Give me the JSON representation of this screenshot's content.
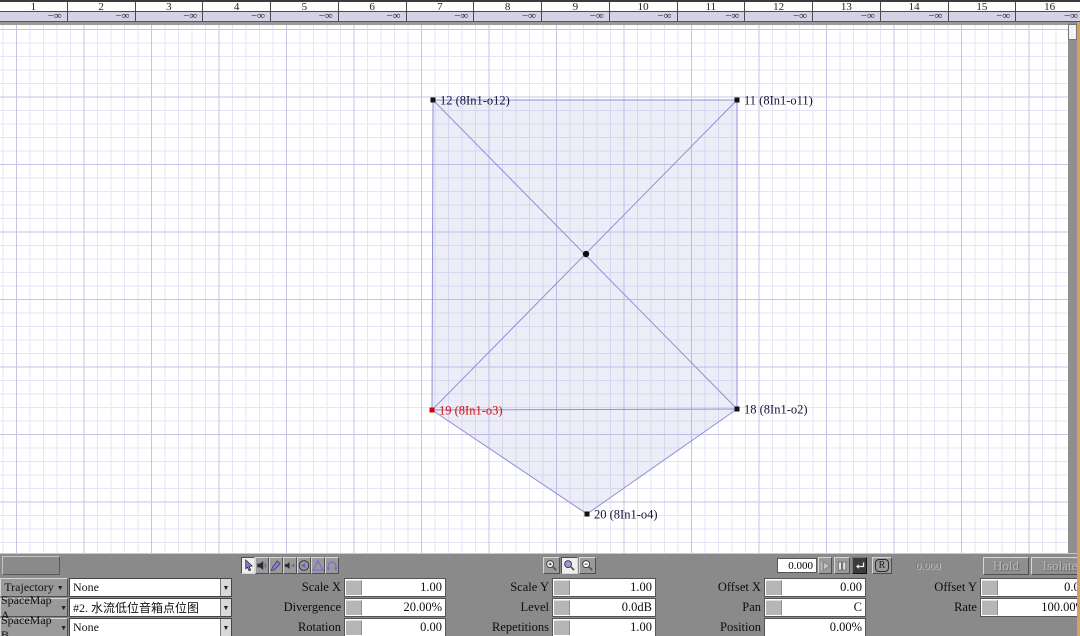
{
  "accent": {
    "grid_major": "#c7c4e7",
    "grid_minor": "#e6e4f5",
    "map_stroke": "#9090d6",
    "map_fill": "rgba(146,146,214,0.16)",
    "selected_red": "#cc1111",
    "panel_gray": "#8a8a8a",
    "meter_lavender": "#d7d1e5",
    "edge_tan": "#cfa55c"
  },
  "channel_meter": {
    "channels": [
      {
        "num": "1",
        "level": "−∞"
      },
      {
        "num": "2",
        "level": "−∞"
      },
      {
        "num": "3",
        "level": "−∞"
      },
      {
        "num": "4",
        "level": "−∞"
      },
      {
        "num": "5",
        "level": "−∞"
      },
      {
        "num": "6",
        "level": "−∞"
      },
      {
        "num": "7",
        "level": "−∞"
      },
      {
        "num": "8",
        "level": "−∞"
      },
      {
        "num": "9",
        "level": "−∞"
      },
      {
        "num": "10",
        "level": "−∞"
      },
      {
        "num": "11",
        "level": "−∞"
      },
      {
        "num": "12",
        "level": "−∞"
      },
      {
        "num": "13",
        "level": "−∞"
      },
      {
        "num": "14",
        "level": "−∞"
      },
      {
        "num": "15",
        "level": "−∞"
      },
      {
        "num": "16",
        "level": "−∞"
      }
    ]
  },
  "canvas": {
    "nodes": [
      {
        "id": "12",
        "label": "12 (8In1-o12)",
        "x": 433,
        "y": 100,
        "color": "#111111",
        "text": "#15153a"
      },
      {
        "id": "11",
        "label": "11 (8In1-o11)",
        "x": 737,
        "y": 100,
        "color": "#111111",
        "text": "#15153a"
      },
      {
        "id": "18",
        "label": "18 (8In1-o2)",
        "x": 737,
        "y": 409,
        "color": "#111111",
        "text": "#15153a"
      },
      {
        "id": "19",
        "label": "19 (8In1-o3)",
        "x": 432,
        "y": 410,
        "color": "#dd0000",
        "text": "#cc1111"
      },
      {
        "id": "20",
        "label": "20 (8In1-o4)",
        "x": 587,
        "y": 514,
        "color": "#111111",
        "text": "#15153a"
      }
    ],
    "center": {
      "x": 586,
      "y": 254
    },
    "fills": [
      [
        "12",
        "11",
        "18",
        "20",
        "19"
      ]
    ],
    "edges": [
      [
        "12",
        "11"
      ],
      [
        "11",
        "18"
      ],
      [
        "18",
        "19"
      ],
      [
        "19",
        "12"
      ],
      [
        "19",
        "20"
      ],
      [
        "20",
        "18"
      ],
      [
        "12",
        "18"
      ],
      [
        "11",
        "19"
      ]
    ]
  },
  "transport": {
    "tools": [
      {
        "name": "cursor-tool",
        "active": true
      },
      {
        "name": "speaker-tool",
        "active": false
      },
      {
        "name": "draw-trajectory-tool",
        "active": false
      },
      {
        "name": "speaker-pan-tool",
        "active": false
      },
      {
        "name": "speaker-solo-tool",
        "active": false
      },
      {
        "name": "triangle-tool",
        "active": false
      },
      {
        "name": "headphones-tool",
        "active": false
      }
    ],
    "zoom_tools": [
      {
        "name": "zoom-in",
        "active": false
      },
      {
        "name": "zoom-fit",
        "active": true
      },
      {
        "name": "zoom-out",
        "active": false
      }
    ],
    "time_value": "0.000",
    "time_readout": "0.000",
    "hold_label": "Hold",
    "isolate_label": "Isolate"
  },
  "controls": {
    "dropdown_rows": [
      {
        "label": "Trajectory",
        "value": "None"
      },
      {
        "label": "SpaceMap A",
        "value": "#2.  水流低位音箱点位图"
      },
      {
        "label": "SpaceMap B",
        "value": "None"
      }
    ],
    "params": [
      [
        {
          "key": "scale-x",
          "label": "Scale X",
          "value": "1.00",
          "slider": true
        },
        {
          "key": "scale-y",
          "label": "Scale Y",
          "value": "1.00",
          "slider": true
        },
        {
          "key": "offset-x",
          "label": "Offset X",
          "value": "0.00",
          "slider": true
        },
        {
          "key": "offset-y",
          "label": "Offset Y",
          "value": "0.00",
          "slider": true
        }
      ],
      [
        {
          "key": "divergence",
          "label": "Divergence",
          "value": "20.00%",
          "slider": true
        },
        {
          "key": "level",
          "label": "Level",
          "value": "0.0dB",
          "slider": true
        },
        {
          "key": "pan",
          "label": "Pan",
          "value": "C",
          "slider": true
        },
        {
          "key": "rate",
          "label": "Rate",
          "value": "100.00%",
          "slider": true
        }
      ],
      [
        {
          "key": "rotation",
          "label": "Rotation",
          "value": "0.00",
          "slider": true
        },
        {
          "key": "repetitions",
          "label": "Repetitions",
          "value": "1.00",
          "slider": true
        },
        {
          "key": "position",
          "label": "Position",
          "value": "0.00%",
          "slider": false
        },
        null
      ]
    ]
  }
}
